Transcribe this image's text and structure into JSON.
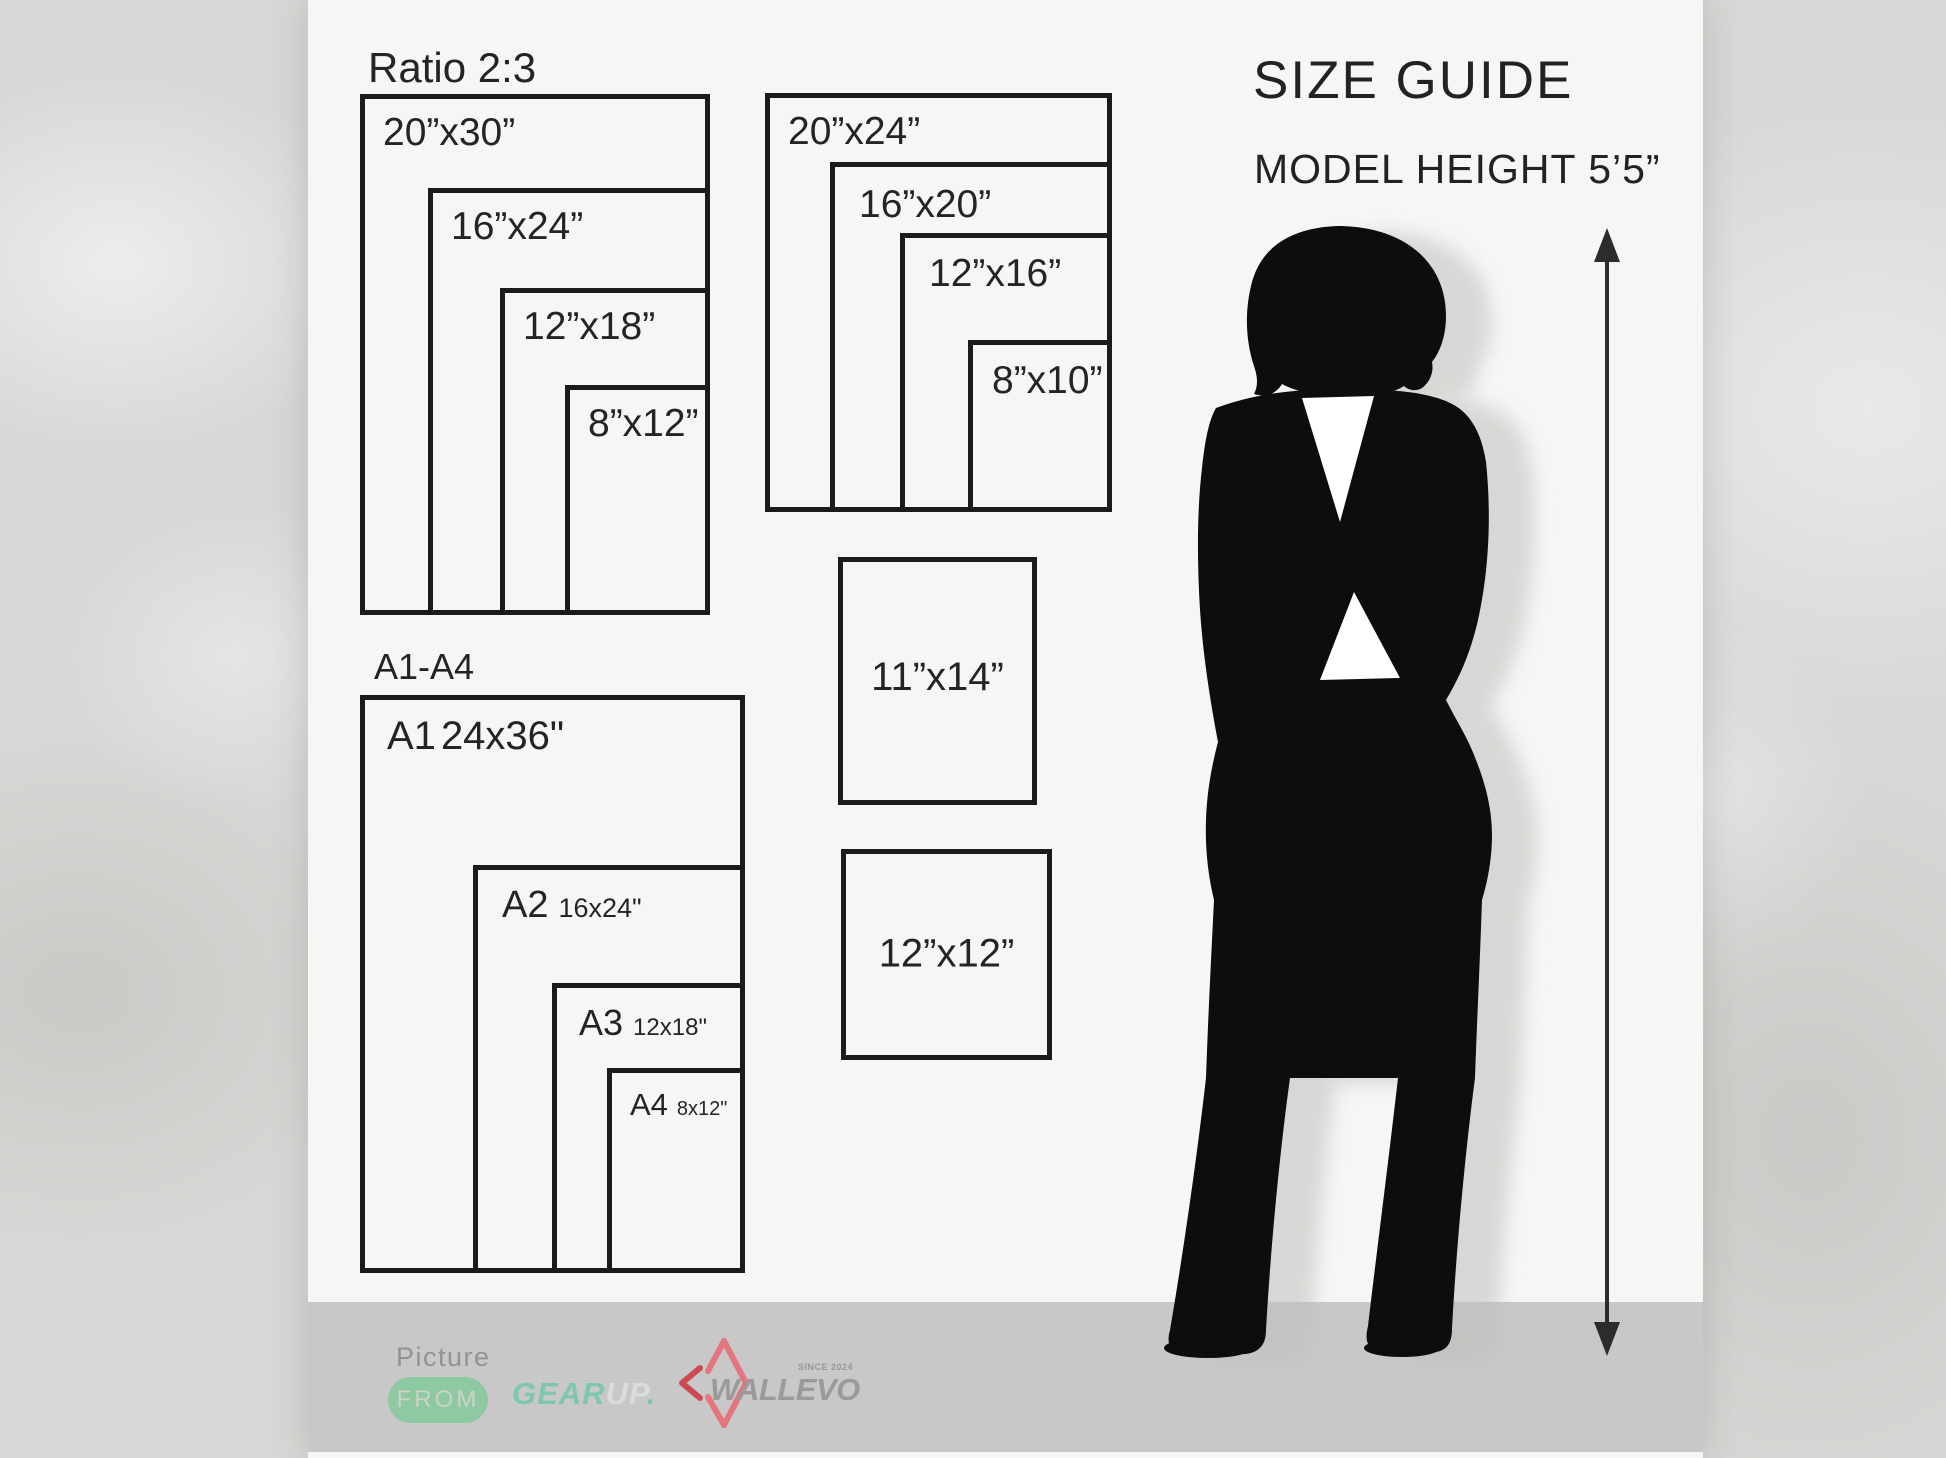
{
  "title": "SIZE GUIDE",
  "subtitle": "MODEL HEIGHT 5’5”",
  "groups": {
    "ratio_2_3": {
      "label": "Ratio 2:3",
      "sizes": [
        "20”x30”",
        "16”x24”",
        "12”x18”",
        "8”x12”"
      ]
    },
    "ratio_4_5": {
      "sizes": [
        "20”x24”",
        "16”x20”",
        "12”x16”",
        "8”x10”"
      ]
    },
    "singles": {
      "sizes": [
        "11”x14”",
        "12”x12”"
      ]
    },
    "a_series": {
      "label": "A1-A4",
      "sizes": [
        {
          "name": "A1",
          "dim": "24x36\""
        },
        {
          "name": "A2",
          "dim": "16x24\""
        },
        {
          "name": "A3",
          "dim": "12x18\""
        },
        {
          "name": "A4",
          "dim": "8x12\""
        }
      ]
    }
  },
  "footer": {
    "picture_label": "Picture",
    "from_label": "FROM",
    "gear_part": "GEAR",
    "up_part": "UP",
    "dot": ".",
    "wallevo": "WALLEVO",
    "since": "SINCE 2024"
  },
  "colors": {
    "canvas": "#f6f6f5",
    "background_texture": "#d8d7d5",
    "line": "#1b1b1b",
    "text": "#242424",
    "band_gray": "#c8c8c8",
    "pill_mint": "#8fc9a1",
    "gear_teal": "#7ec6af",
    "up_pale": "#d9ddda",
    "wallevo_gray": "#9a9a9a",
    "diamond_pink": "#e2757e",
    "chevron_red": "#cc4a52"
  }
}
